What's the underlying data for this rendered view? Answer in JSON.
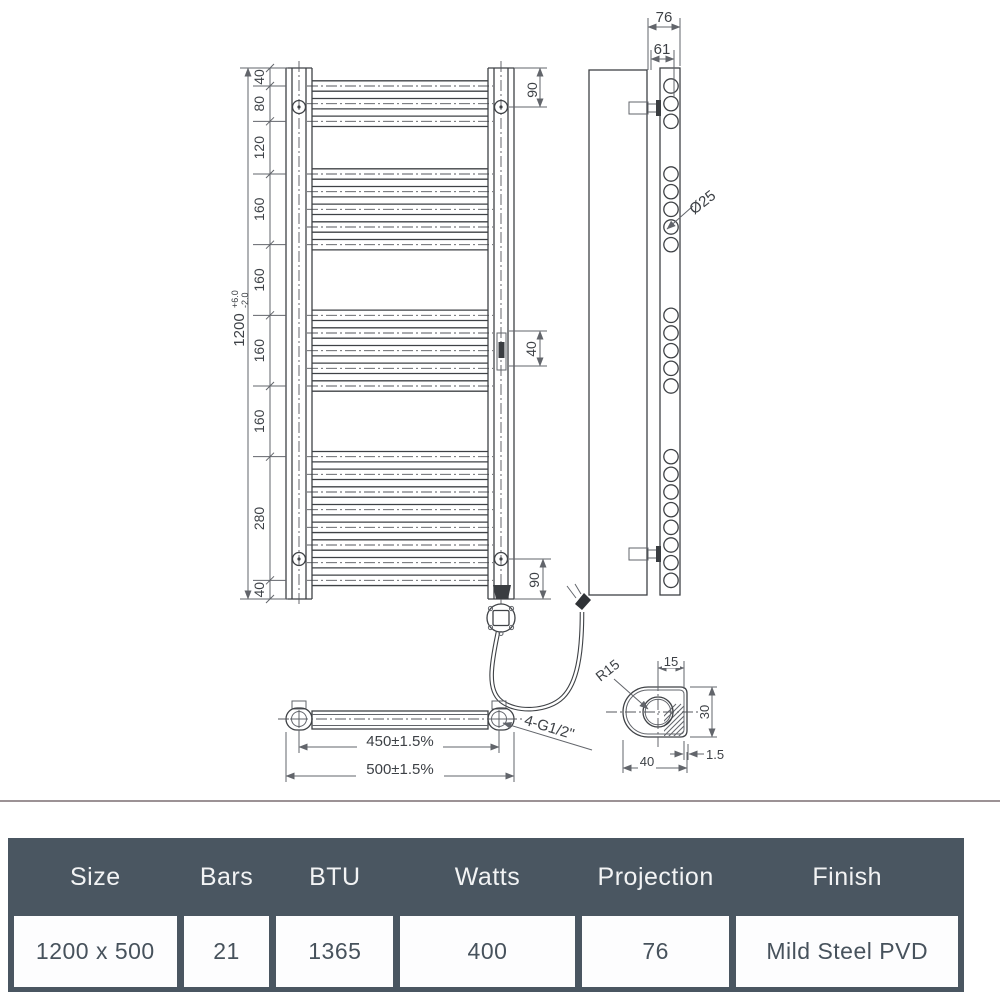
{
  "front": {
    "overall": "1200",
    "tol_plus": "+6.0",
    "tol_minus": "-2.0",
    "segments": [
      "40",
      "80",
      "120",
      "160",
      "160",
      "160",
      "160",
      "280",
      "40"
    ],
    "dim_top_right": "90",
    "dim_mid_right": "40",
    "dim_bottom_right": "90"
  },
  "side": {
    "dim_projection": "76",
    "dim_bracket": "61",
    "dim_bar_dia": "Ø25"
  },
  "plan": {
    "dim_centres": "450±1.5%",
    "dim_overall": "500±1.5%",
    "label_thread": "4-G1/2\""
  },
  "detail": {
    "label_radius": "R15",
    "dim_hole": "15",
    "dim_height": "30",
    "dim_width": "40",
    "dim_wall": "1.5"
  },
  "table": {
    "headers": [
      "Size",
      "Bars",
      "BTU",
      "Watts",
      "Projection",
      "Finish"
    ],
    "row": [
      "1200 x 500",
      "21",
      "1365",
      "400",
      "76",
      "Mild Steel PVD"
    ]
  },
  "colors": {
    "table_header_bg": "#4a5661",
    "table_text": "#47525c",
    "line": "#3f4246",
    "separator": "#9c9295"
  }
}
